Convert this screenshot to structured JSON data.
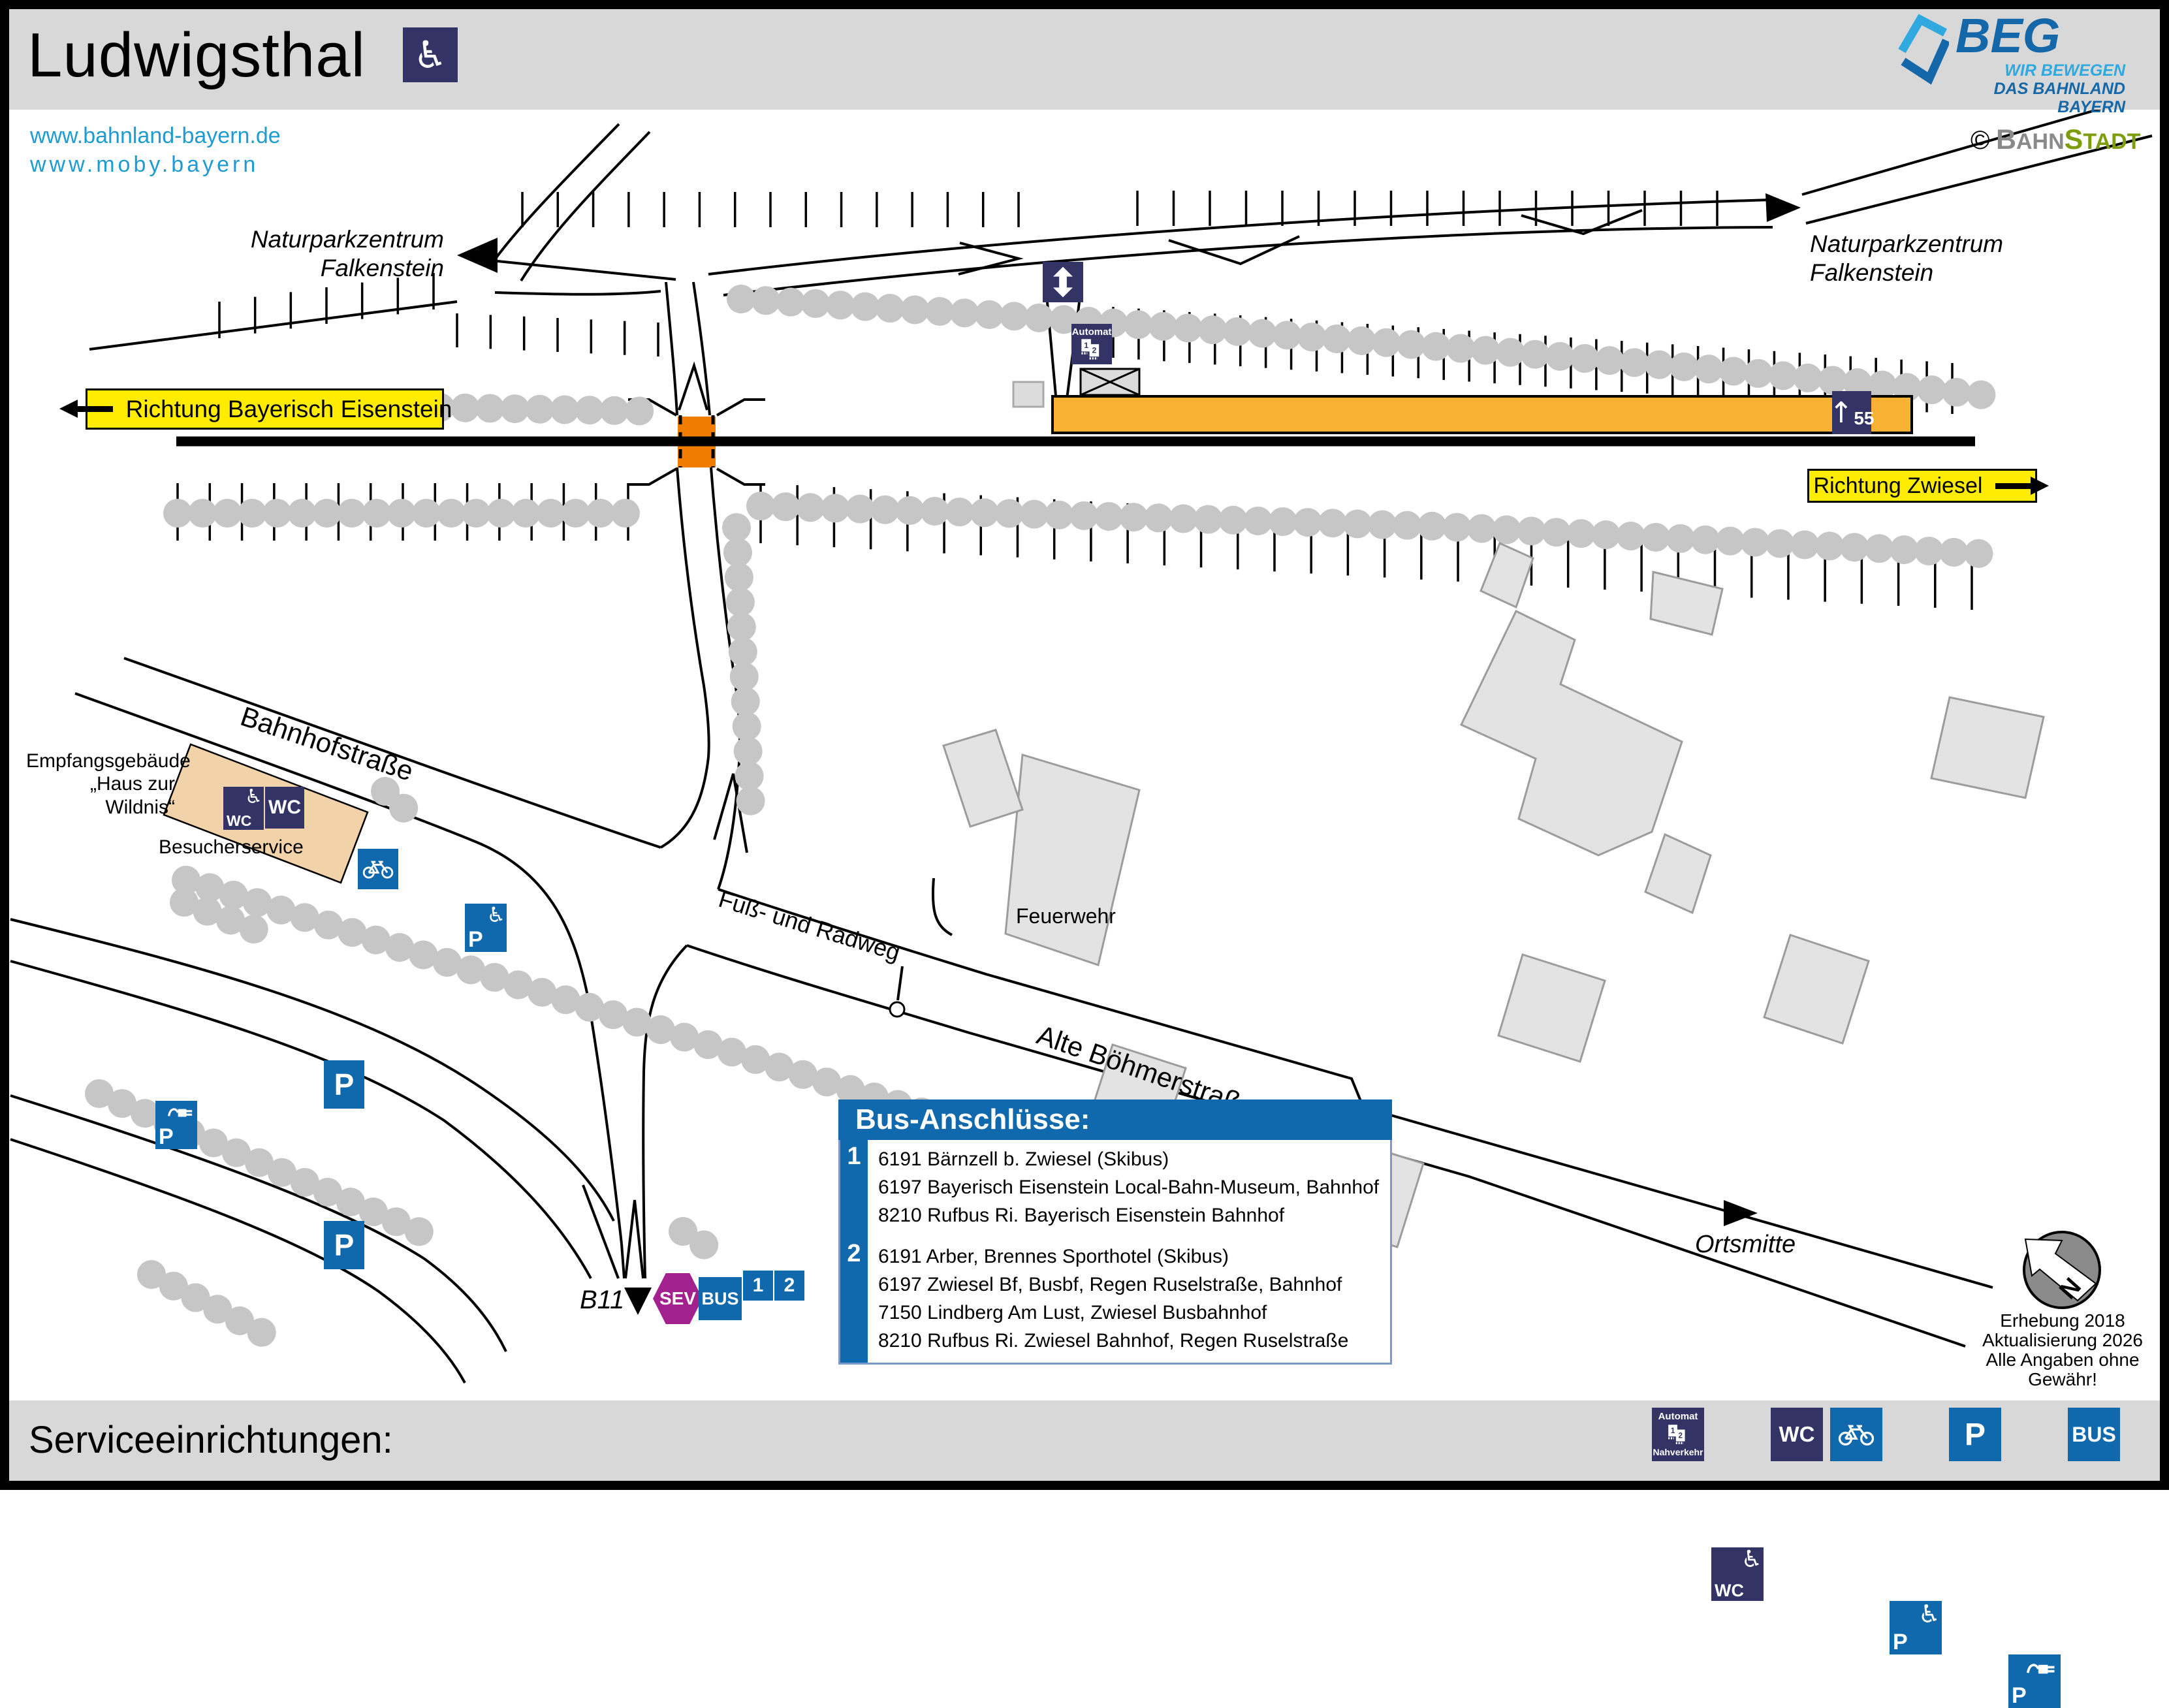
{
  "header": {
    "title": "Ludwigsthal",
    "links": [
      "www.bahnland-bayern.de",
      "www.moby.bayern"
    ],
    "beg": {
      "name": "BEG",
      "tagline1": "WIR BEWEGEN",
      "tagline2": "DAS BAHNLAND BAYERN"
    },
    "credit": {
      "symbol": "©",
      "part1_cap": "B",
      "part1_rest": "AHN",
      "part2_cap": "S",
      "part2_rest": "TADT"
    }
  },
  "map": {
    "signs": {
      "left": "Richtung Bayerisch Eisenstein",
      "right": "Richtung Zwiesel"
    },
    "destination_left": {
      "line1": "Naturparkzentrum",
      "line2": "Falkenstein"
    },
    "destination_right": {
      "line1": "Naturparkzentrum",
      "line2": "Falkenstein"
    },
    "labels": {
      "building1": "Empfangsgebäude",
      "building2": "„Haus zur Wildnis“",
      "visitor_service": "Besucherservice",
      "street1": "Bahnhofstraße",
      "street2": "Fuß- und Radweg",
      "street3": "Alte Böhmerstraße",
      "fire_station": "Feuerwehr",
      "village_center": "Ortsmitte",
      "road": "B11"
    },
    "platform": {
      "arrow": "↑",
      "number": "55"
    },
    "ticket_machine": {
      "title": "Automat",
      "t1": "1",
      "t2": "2"
    },
    "wc": "WC",
    "parking": "P",
    "bus": "BUS",
    "sev": "SEV",
    "stop1": "1",
    "stop2": "2",
    "compass_n": "N",
    "notes": [
      "Erhebung 2018",
      "Aktualisierung 2026",
      "Alle Angaben ohne Gewähr!"
    ]
  },
  "bus_box": {
    "title": "Bus-Anschlüsse:",
    "groups": [
      {
        "stop": "1",
        "lines": [
          "6191 Bärnzell b. Zwiesel (Skibus)",
          "6197 Bayerisch Eisenstein Local-Bahn-Museum, Bahnhof",
          "8210 Rufbus Ri. Bayerisch Eisenstein Bahnhof"
        ]
      },
      {
        "stop": "2",
        "lines": [
          "6191 Arber, Brennes Sporthotel (Skibus)",
          "6197 Zwiesel Bf, Busbf, Regen Ruselstraße, Bahnhof",
          "7150 Lindberg Am Lust, Zwiesel Busbahnhof",
          "8210 Rufbus Ri. Zwiesel Bahnhof, Regen Ruselstraße"
        ]
      }
    ]
  },
  "legend": {
    "title": "Serviceeinrichtungen:",
    "ticket_machine": {
      "top": "Automat",
      "bottom": "Nahverkehr",
      "t1": "1",
      "t2": "2"
    },
    "wc": "WC",
    "parking": "P",
    "bus": "BUS"
  },
  "colors": {
    "navy": "#333366",
    "blue": "#1169AD",
    "yellow": "#FFEC00",
    "platform_orange": "#F9B233",
    "crossing_orange": "#F07D00",
    "sev_purple": "#A3218E",
    "link_blue": "#1E9BD2",
    "beg_blue": "#1467A8",
    "beg_lightblue": "#2FA9E0",
    "stadt_green": "#7E9D0E"
  }
}
